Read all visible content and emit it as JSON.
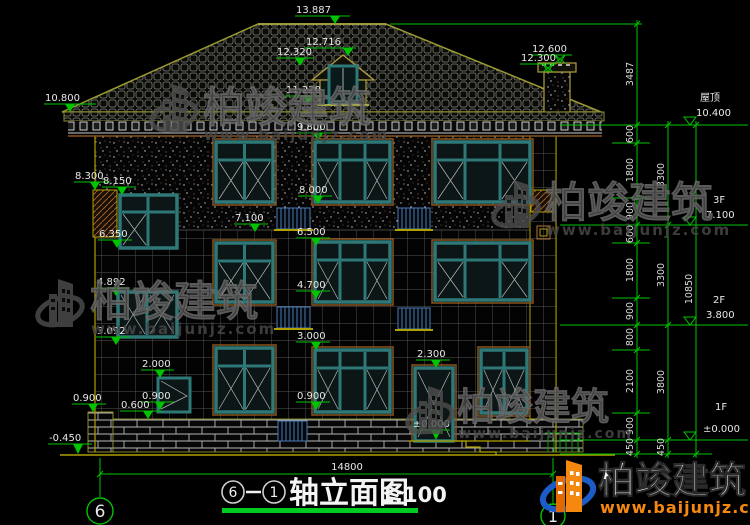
{
  "brand": {
    "name": "柏竣建筑",
    "url": "www.baijunjz.com"
  },
  "elevations": {
    "peak": "13.887",
    "dormer_top": "12.716",
    "dormer_mid": "12.320",
    "dormer_sill": "11.220",
    "chimney_top": "12.600",
    "chimney_bottom": "12.300",
    "eave_left": "10.800",
    "f3_head": "9.800",
    "stair_a": "8.300",
    "stair_a2": "8.150",
    "f3_sill": "8.000",
    "f3_floor": "7.100",
    "f2_head": "6.500",
    "stair_b": "6.350",
    "stair_c": "4.892",
    "f2_sill": "4.700",
    "stair_d": "3.092",
    "f1_head": "3.000",
    "door_head": "2.300",
    "stair_e": "2.000",
    "sill_left": "0.900",
    "sill_stair": "0.900",
    "sill_center": "0.900",
    "plinth": "0.600",
    "zero": "±0.000",
    "ground": "-0.450"
  },
  "right_panel": {
    "levels": [
      {
        "name": "屋顶",
        "elev": "10.400"
      },
      {
        "name": "3F",
        "elev": "7.100"
      },
      {
        "name": "2F",
        "elev": "3.800"
      },
      {
        "name": "1F",
        "elev": "±0.000"
      }
    ],
    "chain1": [
      "3487",
      "600",
      "1800",
      "900",
      "600",
      "1800",
      "900",
      "800",
      "2100",
      "900",
      "450"
    ],
    "chain2": [
      "3300",
      "3300",
      "3800",
      "450"
    ],
    "chain3": [
      "10850"
    ]
  },
  "dims": {
    "total_width": "14800"
  },
  "footer": {
    "axis_left": "6",
    "axis_right": "1",
    "title": "轴立面图",
    "scale": "1:100"
  }
}
